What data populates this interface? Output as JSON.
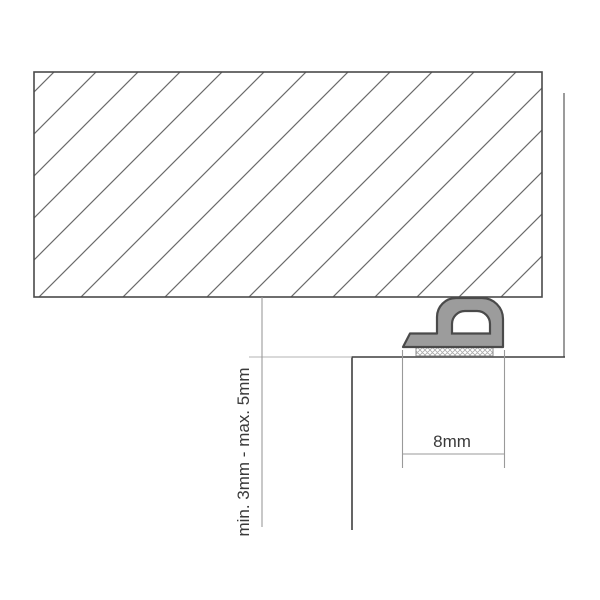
{
  "diagram": {
    "labels": {
      "gap_dimension": "min. 3mm - max. 5mm",
      "width_dimension": "8mm"
    },
    "colors": {
      "background": "#ffffff",
      "seal_fill": "#9c9c9c",
      "seal_outline": "#4a4a4a",
      "frame_outline": "#4a4a4a",
      "hatch_line": "#6b6b6b",
      "door_line": "#3f3f3f",
      "wall_line": "#828282",
      "dimension_line": "#9a9a9a",
      "extension_line": "#b3b3b3",
      "label_text": "#3a3a3a"
    }
  }
}
